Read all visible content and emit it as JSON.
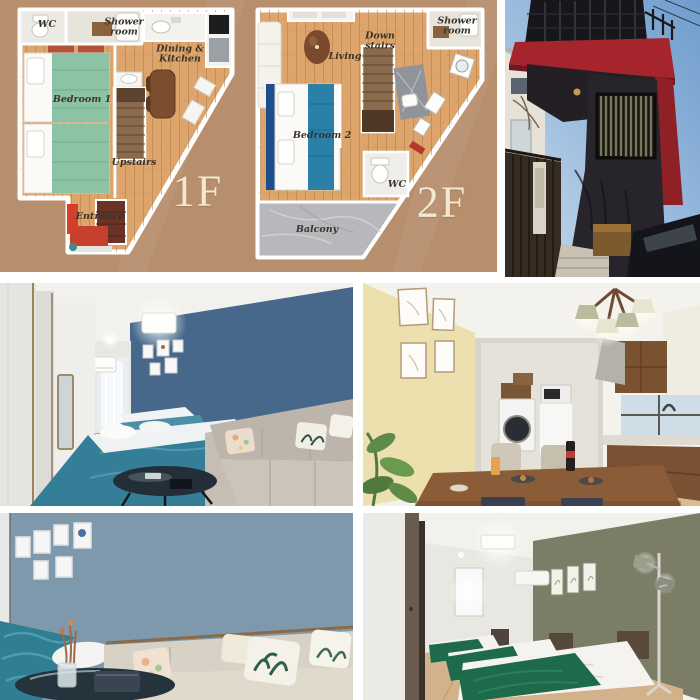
{
  "floorplan": {
    "bg_color": "#b78f6d",
    "wood_color": "#dda56c",
    "label_color": "#3a332c",
    "floor_label_color": "#f2e8d2",
    "f1": {
      "floor_label": "1F",
      "wc": "WC",
      "shower_room": "Shower room",
      "dining_kitchen": "Dining & Kitchen",
      "bedroom": "Bedroom 1",
      "stairs": "Upstairs",
      "entrance": "Entrance"
    },
    "f2": {
      "floor_label": "2F",
      "shower_room": "Shower room",
      "living": "Living",
      "stairs": "Down stairs",
      "bedroom": "Bedroom 2",
      "wc": "WC",
      "balcony": "Balcony"
    }
  },
  "photos": {
    "exterior": {
      "sky_color": "#6f9ccd",
      "sky_light": "#c9dcee",
      "facade_color": "#28242b",
      "accent_red": "#a6242c"
    },
    "bedroom_living": {
      "accent_wall": "#47688a",
      "bed_color": "#357e98"
    },
    "dining_kitchen": {
      "accent_wall": "#ece0ae",
      "cabinet_color": "#7a5230"
    },
    "living_closeup": {
      "accent_wall": "#7e99ab",
      "sofa_color": "#d8d2c6"
    },
    "bedroom_triple": {
      "accent_wall": "#7b7d66",
      "blanket_color": "#1d6b4b"
    }
  }
}
